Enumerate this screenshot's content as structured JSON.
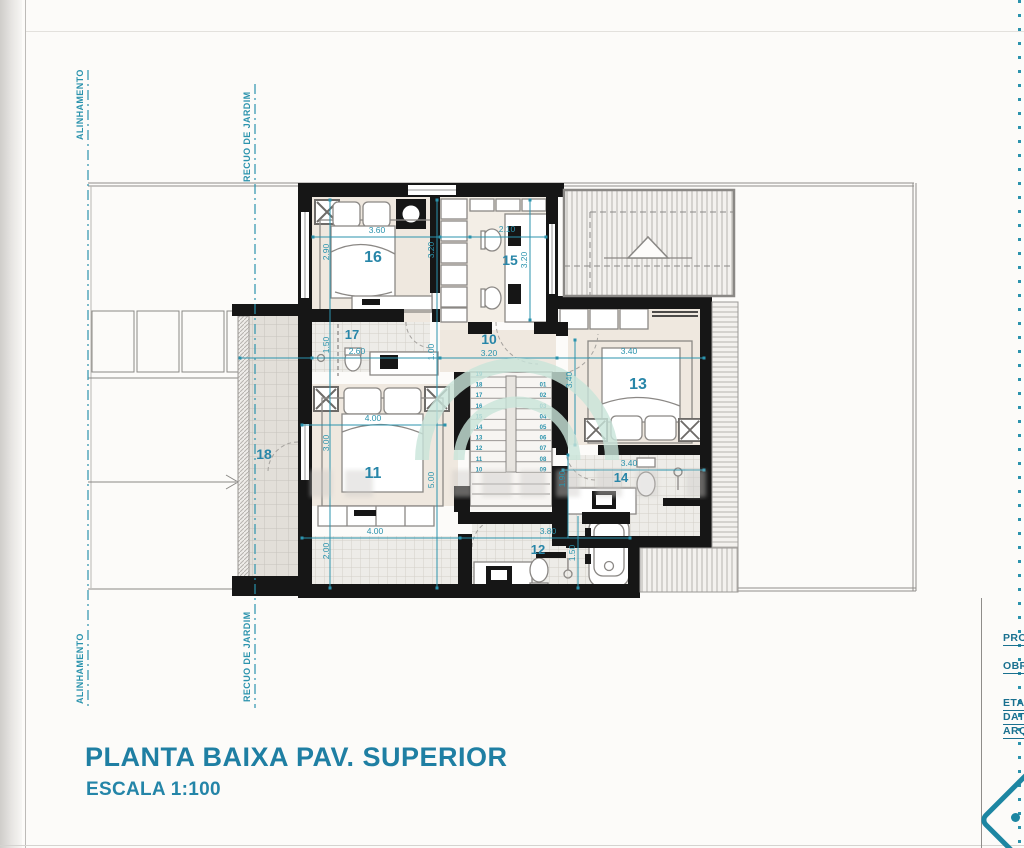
{
  "title": {
    "main": "PLANTA BAIXA PAV. SUPERIOR",
    "scale": "ESCALA 1:100"
  },
  "guide_labels": {
    "alinhamento": "ALINHAMENTO",
    "recuo": "RECUO DE JARDIM"
  },
  "title_block": {
    "labels": [
      "PRO",
      "OBR",
      "ETA",
      "DAT",
      "ARQ"
    ]
  },
  "rooms": {
    "r10": "10",
    "r11": "11",
    "r12": "12",
    "r13": "13",
    "r14": "14",
    "r15": "15",
    "r16": "16",
    "r17": "17",
    "r18": "18"
  },
  "dims": {
    "bed16_width": "3.60",
    "room16_height": "2.90",
    "room16_side": "3.20",
    "desk15_width": "2.10",
    "room15_side": "3.20",
    "hall_width": "3.20",
    "hall_depth": "1.00",
    "bath17_height": "1.50",
    "bath17_width": "2.60",
    "room13_width": "3.40",
    "room13_height": "3.40",
    "bath14_width": "3.40",
    "bath14_height": "1.90",
    "bed11_width": "4.00",
    "bed11_height": "3.00",
    "room11_height": "5.00",
    "room11_width": "4.00",
    "closet_height": "2.00",
    "bath12_width": "3.80",
    "bath12_height": "1.50"
  },
  "stairs": {
    "left": [
      "19",
      "18",
      "17",
      "16",
      "15",
      "14",
      "13",
      "12",
      "11",
      "10"
    ],
    "right": [
      "01",
      "02",
      "03",
      "04",
      "05",
      "06",
      "07",
      "08",
      "09"
    ]
  },
  "colors": {
    "dimension_teal": "#2b93ad",
    "title_text": "#1f7fa3",
    "wall_black": "#161616",
    "site_gray": "#8a8885",
    "watermark_mint": "#c9e5da"
  }
}
